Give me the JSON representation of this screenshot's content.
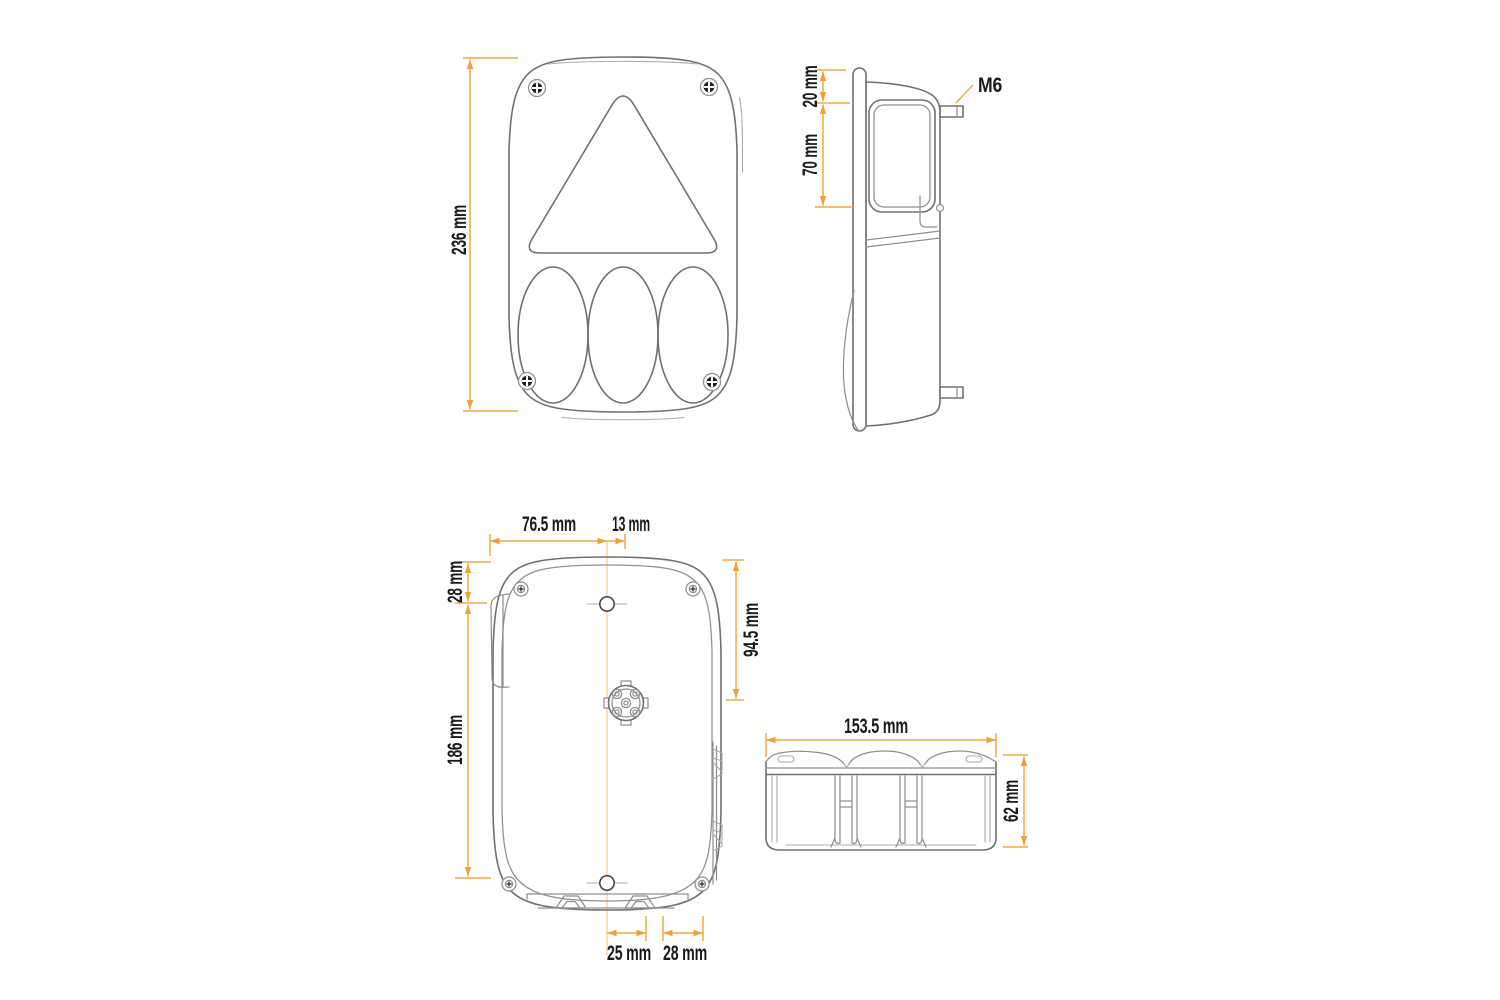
{
  "document_type": "technical-dimension-drawing",
  "subject": "trailer rear lamp",
  "colors": {
    "background": "#FFFFFF",
    "dimension_line": "#F2A944",
    "dimension_arrow": "#EFA03C",
    "centerline": "#F7D9A5",
    "drawing_line": "#707070",
    "drawing_line_light": "#ABABAB",
    "text": "#1A1A1A"
  },
  "views": {
    "front": {
      "dim_height": "236 mm"
    },
    "side": {
      "dim_top": "20 mm",
      "dim_window": "70 mm",
      "stud_label": "M6"
    },
    "rear": {
      "dim_width_left": "76.5 mm",
      "dim_offset": "13 mm",
      "dim_top": "28 mm",
      "dim_right": "94.5 mm",
      "dim_height": "186 mm",
      "dim_bottom_left": "25 mm",
      "dim_bottom_right": "28 mm"
    },
    "bottom": {
      "dim_width": "153.5 mm",
      "dim_height": "62 mm"
    }
  }
}
